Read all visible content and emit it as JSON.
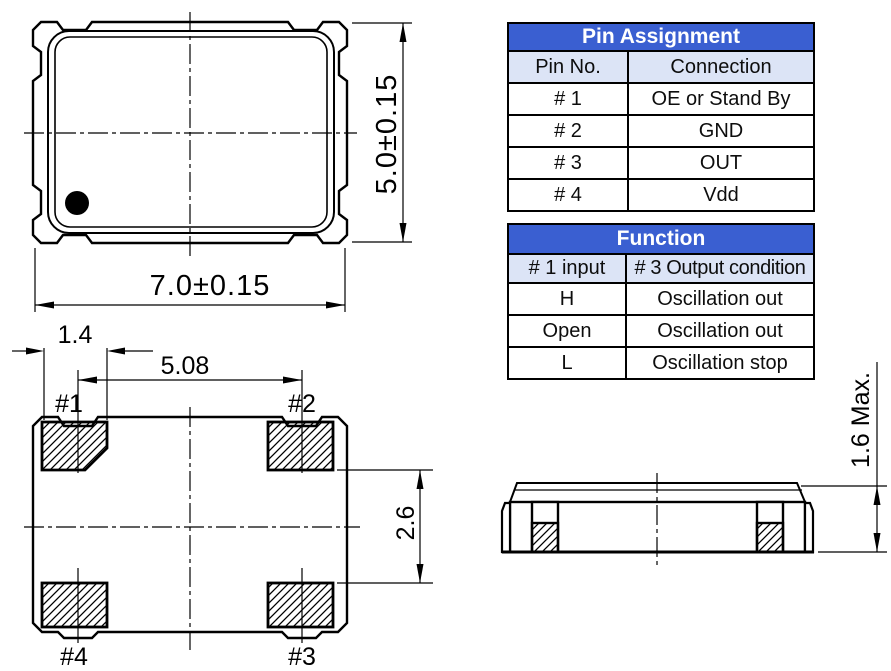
{
  "pin_assignment_table": {
    "title": "Pin Assignment",
    "columns": {
      "pin": "Pin No.",
      "connection": "Connection"
    },
    "rows": [
      {
        "pin": "# 1",
        "connection": "OE or Stand By"
      },
      {
        "pin": "# 2",
        "connection": "GND"
      },
      {
        "pin": "# 3",
        "connection": "OUT"
      },
      {
        "pin": "# 4",
        "connection": "Vdd"
      }
    ]
  },
  "function_table": {
    "title": "Function",
    "columns": {
      "input": "# 1 input",
      "output": "# 3 Output condition"
    },
    "rows": [
      {
        "input": "H",
        "output": "Oscillation out"
      },
      {
        "input": "Open",
        "output": "Oscillation out"
      },
      {
        "input": "L",
        "output": "Oscillation stop"
      }
    ]
  },
  "top_view": {
    "width_dim": "7.0±0.15",
    "height_dim": "5.0±0.15"
  },
  "bottom_view": {
    "edge_to_pad_dim": "1.4",
    "pad_pitch_dim": "5.08",
    "pad_row_gap_dim": "2.6",
    "pad_1_label": "#1",
    "pad_2_label": "#2",
    "pad_3_label": "#3",
    "pad_4_label": "#4"
  },
  "side_view": {
    "height_dim": "1.6 Max."
  },
  "colors": {
    "table_header_bg": "#3a5fd1",
    "table_header_text": "#ffffff",
    "table_subheader_bg": "#dce4f6",
    "line": "#000000",
    "background": "#ffffff"
  }
}
